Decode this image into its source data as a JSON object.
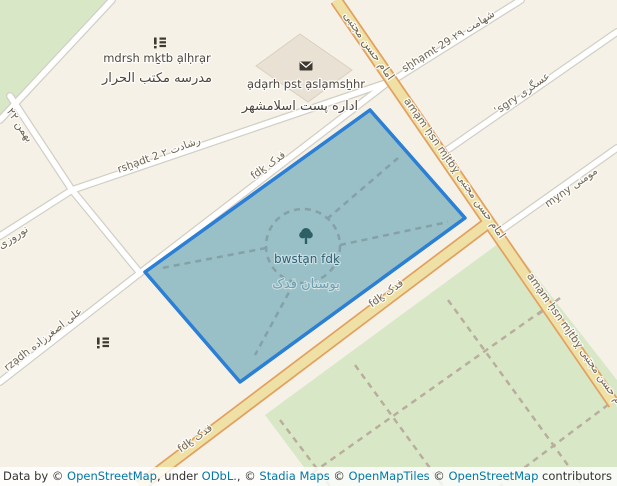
{
  "labels": {
    "streets": {
      "bahman_22": "بهمن ۲۲",
      "noruzi": "نوروزی",
      "reshadat_2": "rsẖạdt 2 رشادت ۲",
      "shahamat_29": "sẖhạmt 29 شهامت ۲۹",
      "asgari": "ʿsgry عسگری",
      "momeni": "mỵny مومنی",
      "imam_hasan_top_fa": "امام حسن مجتبی",
      "imam_hasan_mid": "amạm ḥsn mjtbỵ امام حسن مجتبی",
      "imam_hasan_lower": "amạm ḥsn mjtbỵ امام حسن مجتبی",
      "fadak_path": "fdḵ فدک",
      "fadak_road_mid": "fdḵ فدک",
      "fadak_road_lower": "fdḵ فدک",
      "asgharzadeh": "rzạdh علی اصغرزاده"
    },
    "pois": {
      "school_name": "mdrsh mḵtb ạlḥrạr",
      "school_name_fa": "مدرسه مکتب الحرار",
      "post_office_name": "ạdạrh pst ạslạmsẖhr",
      "post_office_name_fa": "اداره پست اسلامشهر",
      "park_name": "bwstạn fdḵ",
      "park_name_fa": "بوستان فدک"
    },
    "icons": {
      "school_icon": "school-icon",
      "post_icon": "envelope-icon",
      "park_icon": "tree-icon"
    }
  },
  "colors": {
    "background": "#f6f1e6",
    "green_area": "#d8e8c7",
    "park_highlight_fill": "#99bfc7",
    "park_highlight_stroke": "#2b7fd4",
    "road_primary_fill": "#efe0a5",
    "road_primary_casing": "#e2a161",
    "road_minor_fill": "#ffffff",
    "road_minor_casing": "#d2cfc6",
    "link_blue": "#0078a8"
  },
  "attribution": {
    "parts": [
      {
        "text": "Leaflet",
        "link": true
      },
      {
        "text": " | Data by © ",
        "link": false
      },
      {
        "text": "OpenStreetMap",
        "link": true
      },
      {
        "text": ", under ",
        "link": false
      },
      {
        "text": "ODbL.",
        "link": true
      },
      {
        "text": ", © ",
        "link": false
      },
      {
        "text": "Stadia Maps",
        "link": true
      },
      {
        "text": " © ",
        "link": false
      },
      {
        "text": "OpenMapTiles",
        "link": true
      },
      {
        "text": " © ",
        "link": false
      },
      {
        "text": "OpenStreetMap",
        "link": true
      },
      {
        "text": " contributors",
        "link": false
      }
    ]
  }
}
